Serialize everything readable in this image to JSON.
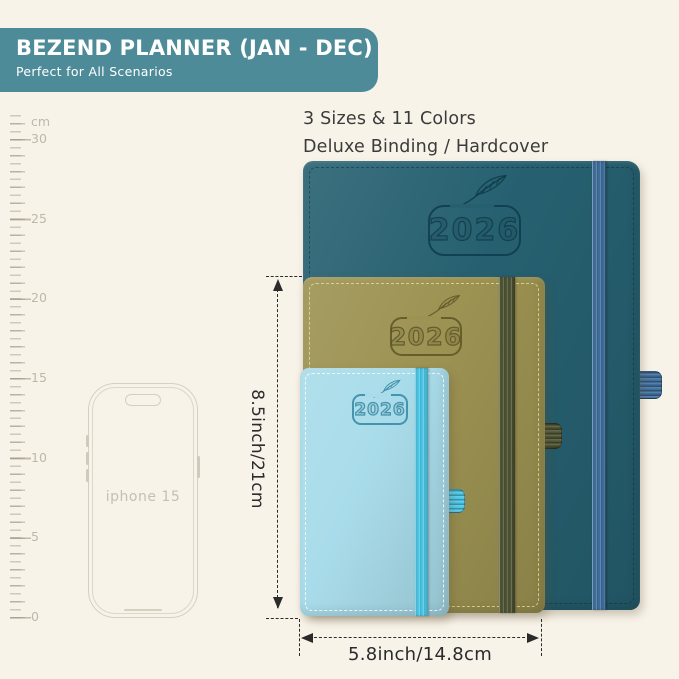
{
  "background_color": "#f8f3e9",
  "banner": {
    "title": "BEZEND PLANNER (JAN - DEC)",
    "subtitle": "Perfect for All Scenarios",
    "bg_color": "#4d8b98",
    "text_color": "#ffffff"
  },
  "info": {
    "line1": "3 Sizes & 11 Colors",
    "line2": "Deluxe Binding / Hardcover"
  },
  "ruler": {
    "unit": "cm",
    "tick_labels": [
      "30",
      "25",
      "20",
      "15",
      "10",
      "5",
      "0"
    ]
  },
  "phone": {
    "label": "iphone 15"
  },
  "planners": {
    "large": {
      "year": "2026",
      "cover_color": "#266070",
      "band_color": "#3f6f9d",
      "emboss_color": "rgba(13,57,73,0.8)"
    },
    "medium": {
      "year": "2026",
      "cover_color": "#9c9252",
      "band_color": "#4e5434",
      "emboss_color": "rgba(92,85,38,0.85)"
    },
    "small": {
      "year": "2026",
      "cover_color": "#a9dcea",
      "band_color": "#4cc8e9",
      "emboss_color": "rgba(58,140,166,0.9)"
    }
  },
  "dimensions": {
    "height_label": "8.5inch/21cm",
    "width_label": "5.8inch/14.8cm"
  }
}
